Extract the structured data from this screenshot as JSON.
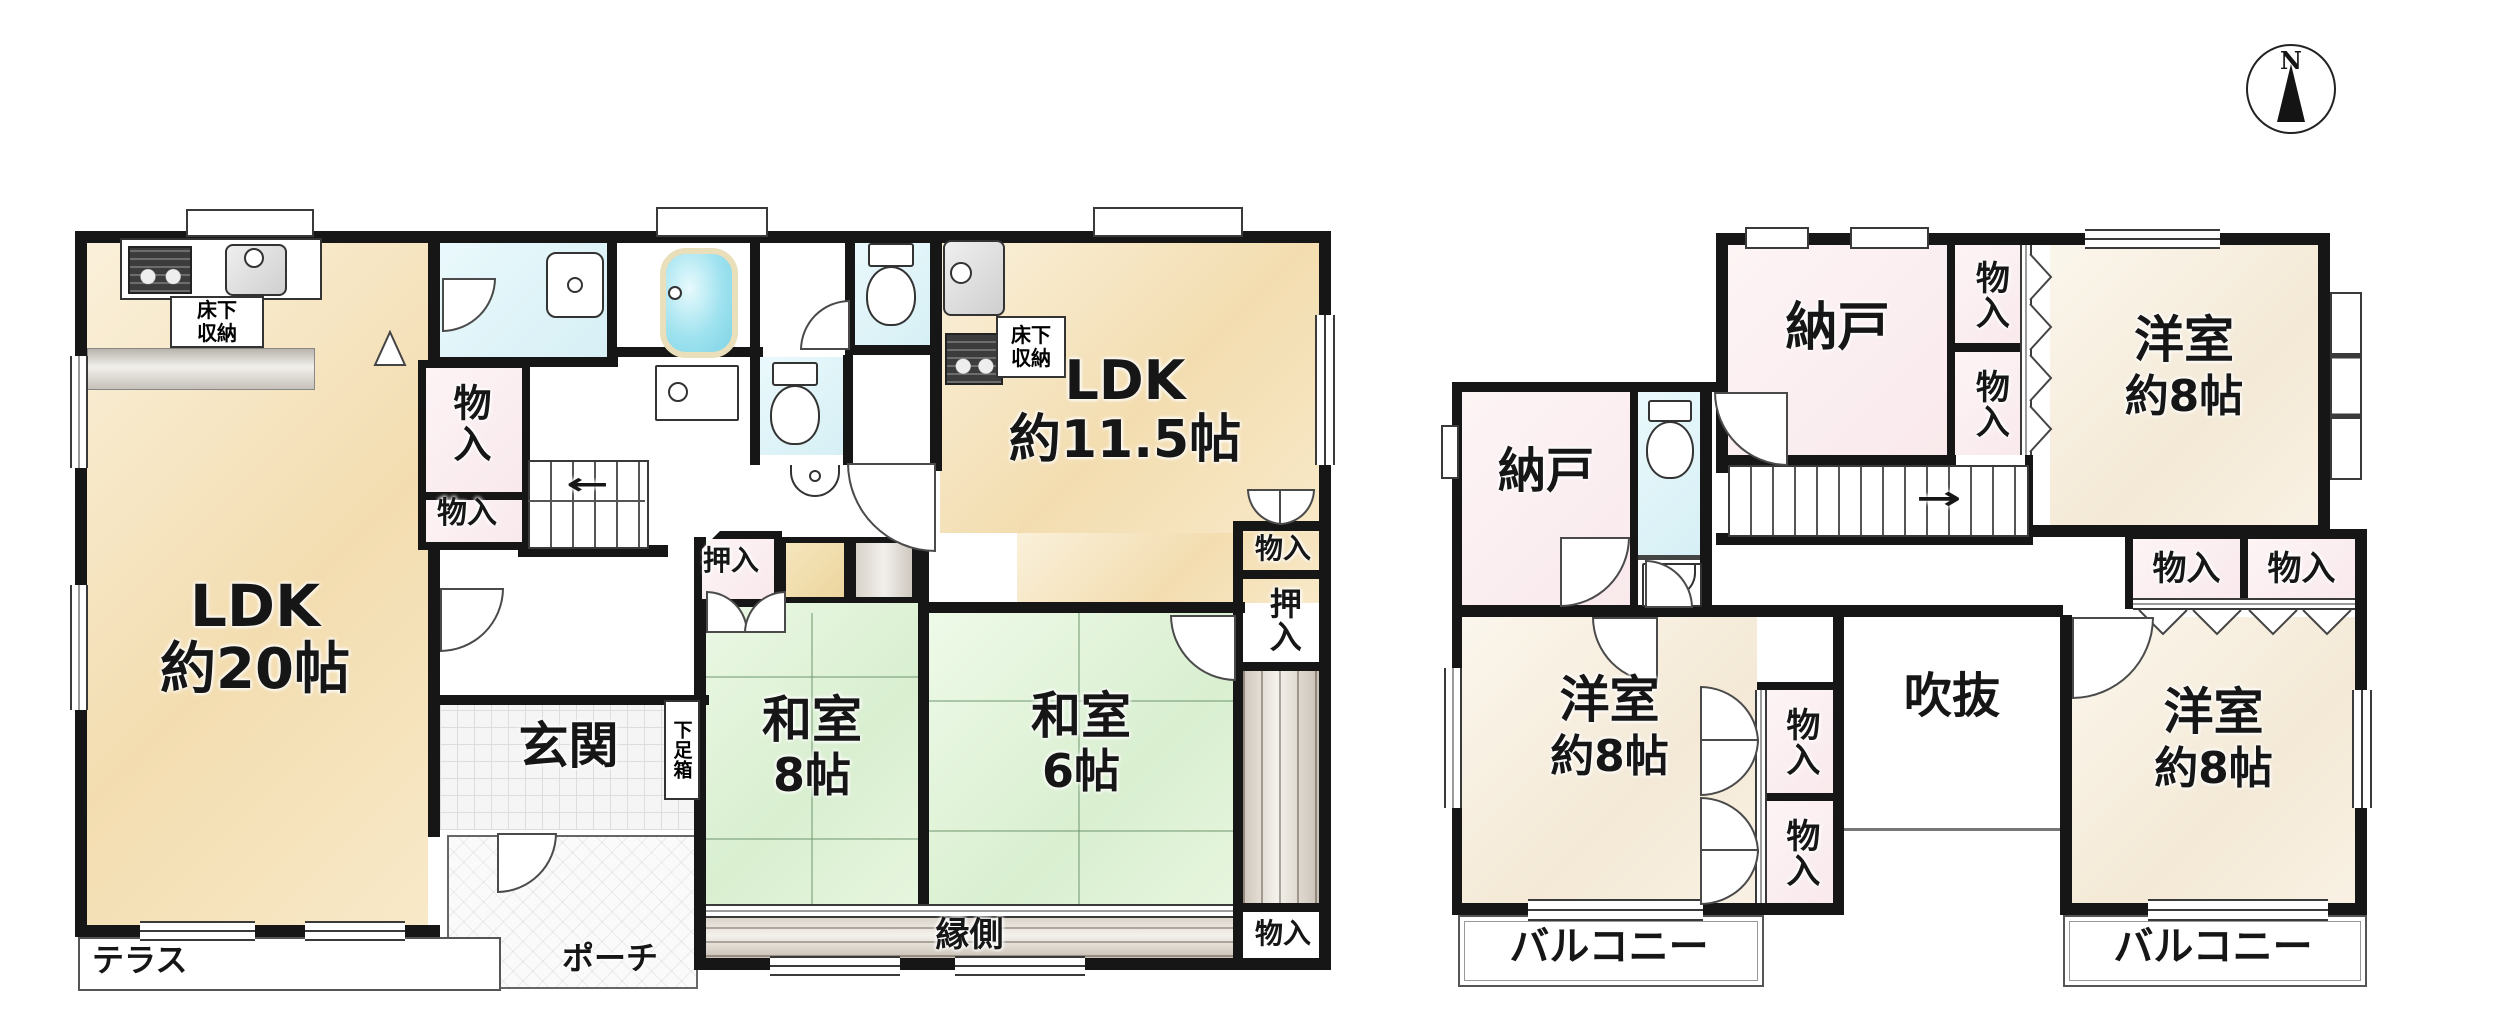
{
  "compass": {
    "north": "N"
  },
  "floor1": {
    "ldk_main": {
      "name": "LDK",
      "size": "約20帖"
    },
    "ldk_sub": {
      "name": "LDK",
      "size": "約11.5帖"
    },
    "washitsu_8": {
      "name": "和室",
      "size": "8帖"
    },
    "washitsu_6": {
      "name": "和室",
      "size": "6帖"
    },
    "genkan": "玄関",
    "terrace": "テラス",
    "porch": "ポーチ",
    "engawa": "縁側",
    "shoe_box": "下足箱",
    "underfloor_storage_main": "床下収納",
    "underfloor_storage_sub": "床下収納",
    "storage_hall_tall": "物入",
    "storage_hall_small": "物入",
    "storage_east_top": "物入",
    "storage_east_bottom": "物入",
    "closet_west": "押入",
    "closet_east": "押入"
  },
  "floor2": {
    "nando_north": "納戸",
    "nando_west": "納戸",
    "storage_north_upper": "物入",
    "storage_north_lower": "物入",
    "storage_center_upper": "物入",
    "storage_center_lower": "物入",
    "storage_east_left": "物入",
    "storage_east_right": "物入",
    "yoshitsu_ne": {
      "name": "洋室",
      "size": "約8帖"
    },
    "yoshitsu_sw": {
      "name": "洋室",
      "size": "約8帖"
    },
    "yoshitsu_se": {
      "name": "洋室",
      "size": "約8帖"
    },
    "void": "吹抜",
    "balcony_west": "バルコニー",
    "balcony_east": "バルコニー"
  }
}
